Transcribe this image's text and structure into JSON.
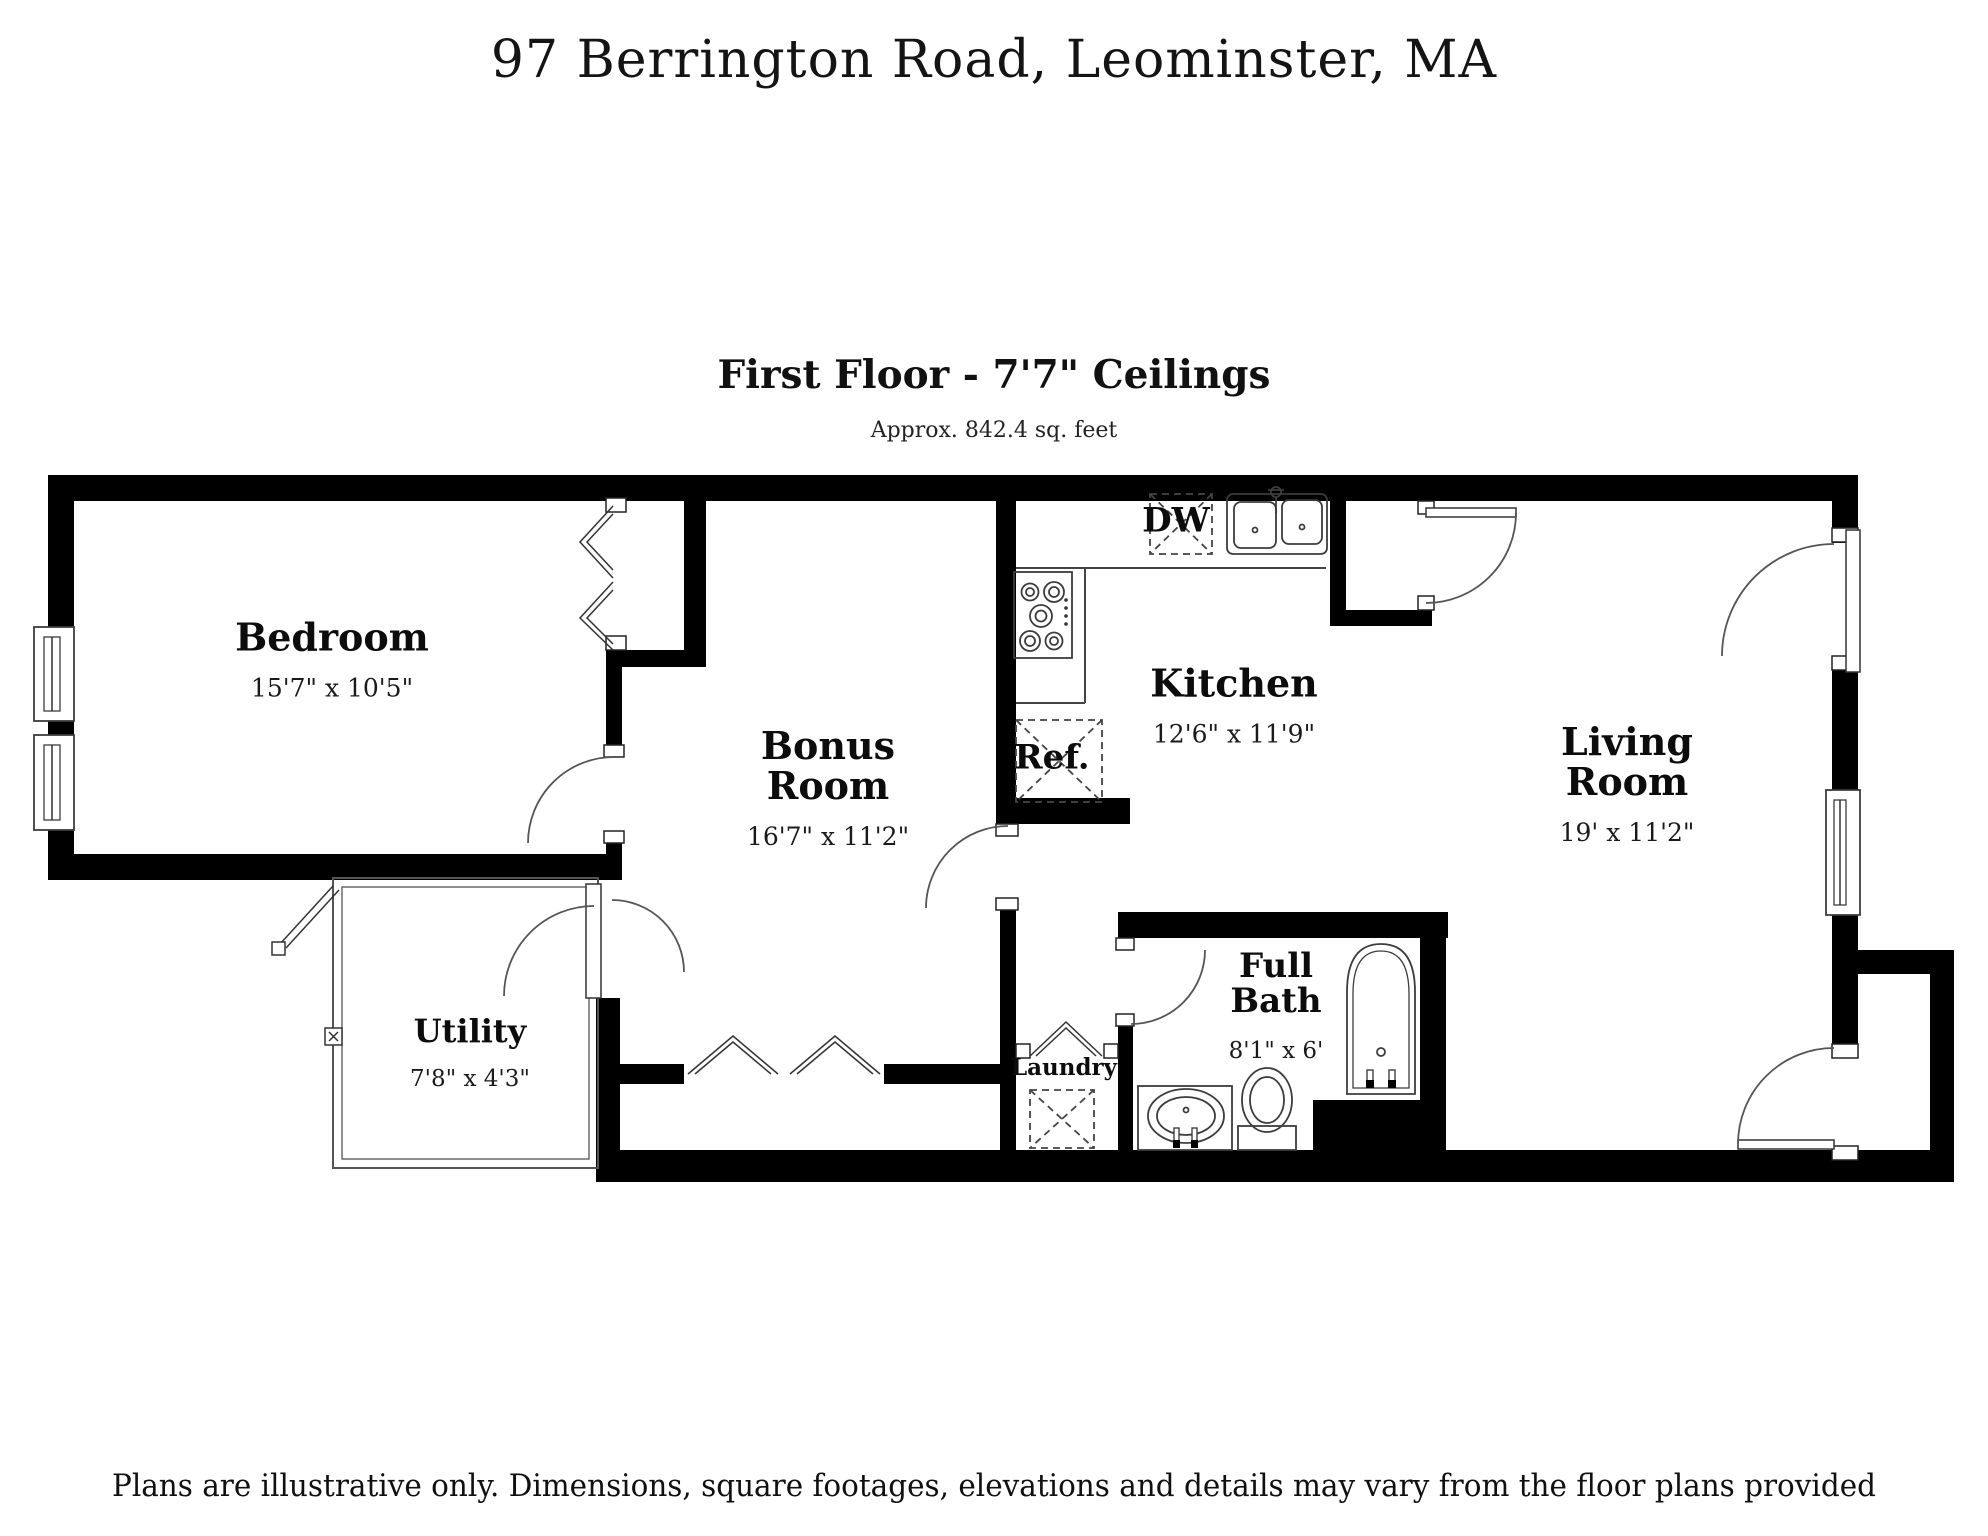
{
  "page": {
    "title": "97 Berrington Road, Leominster, MA",
    "floor_heading": "First Floor - 7'7\" Ceilings",
    "floor_area": "Approx. 842.4 sq. feet",
    "disclaimer": "Plans are illustrative only. Dimensions, square footages, elevations and details may vary from the floor plans provided"
  },
  "rooms": {
    "bedroom": {
      "name": "Bedroom",
      "dims": "15'7\" x 10'5\""
    },
    "bonus": {
      "name": "Bonus\nRoom",
      "dims": "16'7\" x 11'2\""
    },
    "kitchen": {
      "name": "Kitchen",
      "dims": "12'6\" x 11'9\""
    },
    "living": {
      "name": "Living\nRoom",
      "dims": "19' x 11'2\""
    },
    "utility": {
      "name": "Utility",
      "dims": "7'8\" x 4'3\""
    },
    "bath": {
      "name": "Full\nBath",
      "dims": "8'1\" x 6'"
    },
    "laundry": {
      "name": "Laundry"
    }
  },
  "fixtures": {
    "dishwasher": "DW",
    "refrigerator": "Ref."
  },
  "colors": {
    "walls": "#000000",
    "background": "#ffffff",
    "thin_lines": "#444444",
    "text": "#111111"
  }
}
